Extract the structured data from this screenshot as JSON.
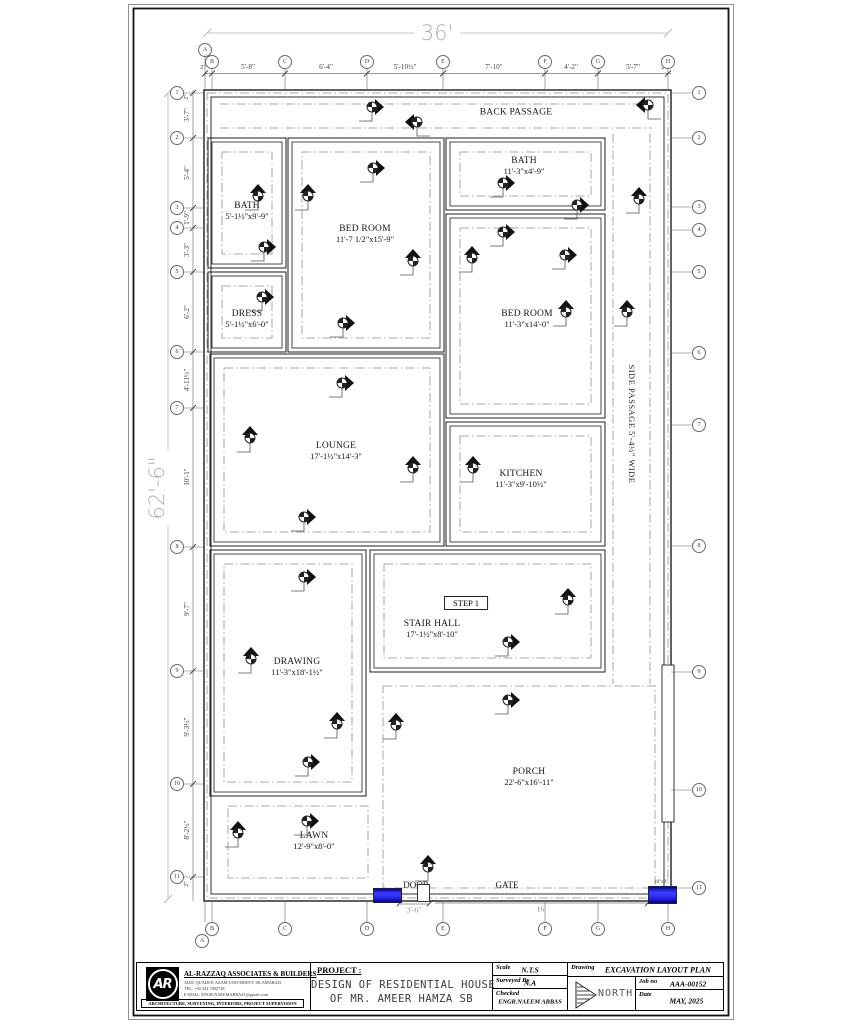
{
  "plan": {
    "overall_top_dim": "36'",
    "overall_left_dim": "62'-6\"",
    "rooms": [
      {
        "name": "BACK PASSAGE",
        "dims": "",
        "x": 516,
        "y": 113
      },
      {
        "name": "BATH",
        "dims": "5'-1½\"x9'-9\"",
        "x": 247,
        "y": 211
      },
      {
        "name": "BED ROOM",
        "dims": "11'-7 1/2\"x15'-9\"",
        "x": 365,
        "y": 234
      },
      {
        "name": "BATH",
        "dims": "11'-3\"x4'-9\"",
        "x": 524,
        "y": 166
      },
      {
        "name": "DRESS",
        "dims": "5'-1½\"x6'-0\"",
        "x": 247,
        "y": 319
      },
      {
        "name": "BED ROOM",
        "dims": "11'-3\"x14'-0\"",
        "x": 527,
        "y": 319
      },
      {
        "name": "LOUNGE",
        "dims": "17'-1½\"x14'-3\"",
        "x": 336,
        "y": 451
      },
      {
        "name": "KITCHEN",
        "dims": "11'-3\"x9'-10½\"",
        "x": 521,
        "y": 479
      },
      {
        "name": "STAIR HALL",
        "dims": "17'-1½\"x8'-10\"",
        "x": 432,
        "y": 629
      },
      {
        "name": "DRAWING",
        "dims": "11'-3\"x18'-1½\"",
        "x": 297,
        "y": 667
      },
      {
        "name": "PORCH",
        "dims": "22'-6\"x16'-11\"",
        "x": 529,
        "y": 777
      },
      {
        "name": "LAWN",
        "dims": "12'-9\"x8'-0\"",
        "x": 314,
        "y": 841
      }
    ],
    "side_passage_label": "SIDE PASSAGE 5'-4½\" WIDE",
    "step_label": "STEP 1",
    "door_label": "DOOR",
    "gate_label": "GATE",
    "pillar_size_label": "18\"x9\"",
    "door_width_dim": "3'-6\"",
    "gate_width_dim": "16'",
    "top_chain": [
      "2\"",
      "2\"",
      "5'-8\"",
      "6'-4\"",
      "5'-10½\"",
      "7'-10\"",
      "4'-2\"",
      "5'-7\"",
      "2\""
    ],
    "left_chain": [
      "2\"",
      "3'-7\"",
      "5'-4\"",
      "1'-9\"",
      "3'-3\"",
      "6'-2\"",
      "4'-11½\"",
      "10'-1\"",
      "9'-7\"",
      "9'-3½\"",
      "8'-2½\"",
      "2\""
    ],
    "grid_cols": [
      "A",
      "B",
      "C",
      "D",
      "E",
      "F",
      "G",
      "H"
    ],
    "grid_rows": [
      "1",
      "2",
      "3",
      "4",
      "5",
      "6",
      "7",
      "8",
      "9",
      "10",
      "11"
    ]
  },
  "markers": [
    {
      "x": 372,
      "y": 107,
      "d": "right"
    },
    {
      "x": 417,
      "y": 122,
      "d": "left"
    },
    {
      "x": 648,
      "y": 105,
      "d": "left"
    },
    {
      "x": 258,
      "y": 196,
      "d": "up"
    },
    {
      "x": 264,
      "y": 247,
      "d": "right"
    },
    {
      "x": 262,
      "y": 297,
      "d": "right"
    },
    {
      "x": 308,
      "y": 196,
      "d": "up"
    },
    {
      "x": 373,
      "y": 168,
      "d": "right"
    },
    {
      "x": 413,
      "y": 261,
      "d": "up"
    },
    {
      "x": 343,
      "y": 323,
      "d": "right"
    },
    {
      "x": 503,
      "y": 183,
      "d": "right"
    },
    {
      "x": 577,
      "y": 205,
      "d": "right"
    },
    {
      "x": 503,
      "y": 232,
      "d": "right"
    },
    {
      "x": 565,
      "y": 255,
      "d": "right"
    },
    {
      "x": 472,
      "y": 258,
      "d": "up"
    },
    {
      "x": 566,
      "y": 312,
      "d": "up"
    },
    {
      "x": 639,
      "y": 199,
      "d": "up"
    },
    {
      "x": 627,
      "y": 312,
      "d": "up"
    },
    {
      "x": 342,
      "y": 383,
      "d": "right"
    },
    {
      "x": 250,
      "y": 438,
      "d": "up"
    },
    {
      "x": 413,
      "y": 468,
      "d": "up"
    },
    {
      "x": 304,
      "y": 517,
      "d": "right"
    },
    {
      "x": 473,
      "y": 468,
      "d": "up"
    },
    {
      "x": 304,
      "y": 577,
      "d": "right"
    },
    {
      "x": 568,
      "y": 600,
      "d": "up"
    },
    {
      "x": 508,
      "y": 642,
      "d": "right"
    },
    {
      "x": 251,
      "y": 659,
      "d": "up"
    },
    {
      "x": 337,
      "y": 724,
      "d": "up"
    },
    {
      "x": 308,
      "y": 762,
      "d": "right"
    },
    {
      "x": 508,
      "y": 700,
      "d": "right"
    },
    {
      "x": 396,
      "y": 725,
      "d": "up"
    },
    {
      "x": 238,
      "y": 833,
      "d": "up"
    },
    {
      "x": 307,
      "y": 821,
      "d": "right"
    },
    {
      "x": 428,
      "y": 867,
      "d": "up"
    }
  ],
  "title_block": {
    "company_name": "AL-RAZZAQ ASSOCIATES & BUILDERS",
    "logo_text": "AR",
    "address_line": "ADD:   QUAID-E-AZAM UNIVERSITY ISLAMABAD",
    "tel_line": "TEL:    +92 342 7002728",
    "email_line": "E-MAIL: ENGR.NAEEMABBAS1@gmail.com",
    "tagline": "ARCHITECTURE,  SURVEYING,  INTERIORS,  PROJECT  SUPERVISION",
    "project_label": "PROJECT :",
    "project_line1": "DESIGN OF RESIDENTIAL HOUSE",
    "project_line2": "OF MR. AMEER HAMZA SB",
    "scale_label": "Scale",
    "scale_value": "N.T.S",
    "surveyed_label": "Surveyed By",
    "surveyed_value": "N.A",
    "checked_label": "Checked",
    "checked_value": "ENGR.NAEEM ABBAS",
    "drawing_label": "Drawing",
    "drawing_value": "EXCAVATION LAYOUT PLAN",
    "north_label": "NORTH",
    "job_label": "Job no",
    "job_value": "AAA-00152",
    "date_label": "Date",
    "date_value": "MAY, 2025"
  },
  "colors": {
    "door_blue": "#2a2aef",
    "dim_gray": "#8b8b8b",
    "line_dark": "#1c1c1c"
  }
}
